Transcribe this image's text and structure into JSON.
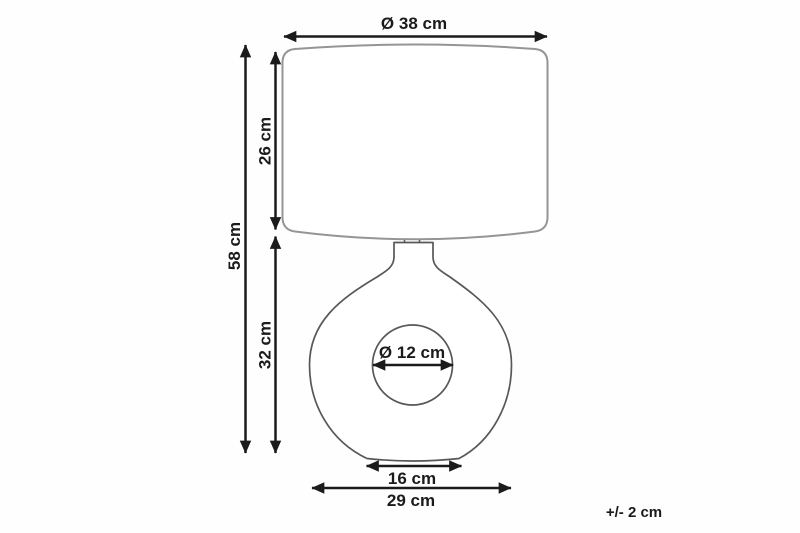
{
  "diagram": {
    "kind": "product-dimension-diagram",
    "subject": "table-lamp",
    "dimensions": {
      "shade_diameter": "Ø 38 cm",
      "shade_height": "26 cm",
      "total_height": "58 cm",
      "base_height": "32 cm",
      "hole_diameter": "Ø 12 cm",
      "base_bottom_width": "16 cm",
      "base_width": "29 cm"
    },
    "tolerance_note": "+/- 2 cm",
    "colors": {
      "dimension": "#1b1b1b",
      "shade_outline": "#959595",
      "base_outline": "#585858",
      "background": "#fefefe"
    }
  }
}
